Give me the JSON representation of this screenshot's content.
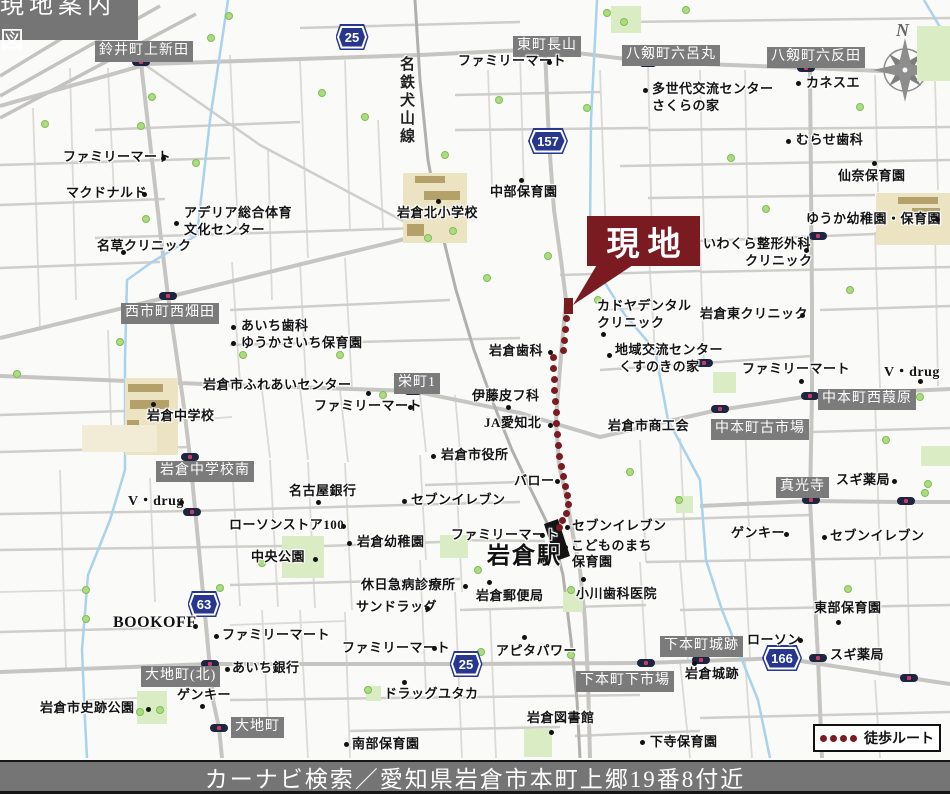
{
  "title": "現地案内図",
  "caption": "カーナビ検索／愛知県岩倉市本町上郷19番8付近",
  "site_label": "現地",
  "station_label": "岩倉駅",
  "railway_label": "名鉄犬山線",
  "legend_label": "徒歩ルート",
  "compass_letter": "N",
  "colors": {
    "accent_maroon": "#7a1b21",
    "shield_blue": "#27368f",
    "district_label_gray": "#7b7b7b",
    "park_green": "#d9ecc3",
    "school_tan": "#ece3c2",
    "water_blue": "#a9d2ec",
    "road_gray": "#c6c5c1"
  },
  "map": {
    "legend_dot_count": 4,
    "shields": [
      {
        "x": 352,
        "y": 37,
        "num": "25"
      },
      {
        "x": 548,
        "y": 141,
        "num": "157"
      },
      {
        "x": 204,
        "y": 604,
        "num": "63"
      },
      {
        "x": 466,
        "y": 664,
        "num": "25"
      },
      {
        "x": 782,
        "y": 658,
        "num": "166"
      }
    ],
    "area_labels": [
      {
        "x": 95,
        "y": 41,
        "t": "鈴井町上新田"
      },
      {
        "x": 513,
        "y": 36,
        "t": "東町長山"
      },
      {
        "x": 622,
        "y": 45,
        "t": "八剱町六呂丸"
      },
      {
        "x": 767,
        "y": 47,
        "t": "八剱町六反田"
      },
      {
        "x": 121,
        "y": 303,
        "t": "西市町西畑田"
      },
      {
        "x": 394,
        "y": 373,
        "t": "栄町1"
      },
      {
        "x": 818,
        "y": 389,
        "t": "中本町西葭原"
      },
      {
        "x": 711,
        "y": 419,
        "t": "中本町古市場"
      },
      {
        "x": 156,
        "y": 461,
        "t": "岩倉中学校南"
      },
      {
        "x": 776,
        "y": 477,
        "t": "真光寺"
      },
      {
        "x": 660,
        "y": 636,
        "t": "下本町城跡"
      },
      {
        "x": 141,
        "y": 666,
        "t": "大地町(北)"
      },
      {
        "x": 576,
        "y": 671,
        "t": "下本町下市場"
      },
      {
        "x": 231,
        "y": 717,
        "t": "大地町"
      }
    ],
    "pois": [
      {
        "t": "ファミリーマート",
        "x": 63,
        "y": 150,
        "dot": [
          163,
          158
        ]
      },
      {
        "t": "マクドナルド",
        "x": 66,
        "y": 186,
        "dot": [
          144,
          194
        ]
      },
      {
        "t": "アデリア総合体育",
        "x": 184,
        "y": 206,
        "dot": [
          176,
          223
        ]
      },
      {
        "t": "文化センター",
        "x": 184,
        "y": 223,
        "dot": null
      },
      {
        "t": "名草クリニック",
        "x": 97,
        "y": 239,
        "dot": [
          123,
          252
        ]
      },
      {
        "t": "ファミリーマート",
        "x": 458,
        "y": 54,
        "dot": [
          549,
          62
        ]
      },
      {
        "t": "多世代交流センター",
        "x": 652,
        "y": 82,
        "dot": [
          645,
          90
        ]
      },
      {
        "t": "さくらの家",
        "x": 652,
        "y": 99,
        "dot": null
      },
      {
        "t": "カネスエ",
        "x": 806,
        "y": 76,
        "dot": [
          798,
          83
        ]
      },
      {
        "t": "むらせ歯科",
        "x": 796,
        "y": 133,
        "dot": [
          788,
          141
        ]
      },
      {
        "t": "仙奈保育園",
        "x": 838,
        "y": 169,
        "dot": [
          874,
          163
        ]
      },
      {
        "t": "ゆうか幼稚園・保育園",
        "x": 806,
        "y": 212,
        "dot": [
          937,
          219
        ]
      },
      {
        "t": "いわくら整形外科",
        "x": 703,
        "y": 237,
        "dot": [
          806,
          250
        ]
      },
      {
        "t": "クリニック",
        "x": 745,
        "y": 254,
        "dot": null
      },
      {
        "t": "中部保育園",
        "x": 490,
        "y": 185,
        "dot": [
          521,
          180
        ]
      },
      {
        "t": "岩倉北小学校",
        "x": 397,
        "y": 206,
        "dot": [
          438,
          201
        ]
      },
      {
        "t": "カドヤデンタル",
        "x": 597,
        "y": 299,
        "dot": [
          603,
          334
        ]
      },
      {
        "t": "クリニック",
        "x": 597,
        "y": 316,
        "dot": null
      },
      {
        "t": "岩倉東クリニック",
        "x": 700,
        "y": 307,
        "dot": [
          802,
          315
        ]
      },
      {
        "t": "地域交流センター",
        "x": 615,
        "y": 343,
        "dot": [
          609,
          355
        ]
      },
      {
        "t": "くすのきの家",
        "x": 619,
        "y": 360,
        "dot": null
      },
      {
        "t": "ファミリーマート",
        "x": 742,
        "y": 362,
        "dot": [
          801,
          381
        ]
      },
      {
        "t": "V・drug",
        "x": 884,
        "y": 365,
        "dot": [
          920,
          381
        ],
        "fs": 14
      },
      {
        "t": "岩倉歯科",
        "x": 489,
        "y": 344,
        "dot": [
          550,
          352
        ]
      },
      {
        "t": "あいち歯科",
        "x": 241,
        "y": 319,
        "dot": [
          233,
          327
        ]
      },
      {
        "t": "ゆうかさいち保育園",
        "x": 241,
        "y": 336,
        "dot": [
          233,
          343
        ]
      },
      {
        "t": "岩倉市ふれあいセンター",
        "x": 203,
        "y": 378,
        "dot": [
          368,
          393
        ]
      },
      {
        "t": "ファミリーマート",
        "x": 314,
        "y": 399,
        "dot": [
          410,
          407
        ]
      },
      {
        "t": "伊藤皮フ科",
        "x": 472,
        "y": 389,
        "dot": [
          508,
          407
        ]
      },
      {
        "t": "JA愛知北",
        "x": 484,
        "y": 416,
        "dot": [
          550,
          425
        ]
      },
      {
        "t": "岩倉市役所",
        "x": 441,
        "y": 448,
        "dot": [
          433,
          456
        ]
      },
      {
        "t": "バロー",
        "x": 514,
        "y": 474,
        "dot": [
          557,
          481
        ]
      },
      {
        "t": "名古屋銀行",
        "x": 289,
        "y": 484,
        "dot": [
          318,
          502
        ]
      },
      {
        "t": "セブンイレブン",
        "x": 411,
        "y": 493,
        "dot": [
          404,
          501
        ]
      },
      {
        "t": "ローソンストア100",
        "x": 229,
        "y": 518,
        "dot": [
          343,
          526
        ]
      },
      {
        "t": "岩倉幼稚園",
        "x": 357,
        "y": 535,
        "dot": [
          349,
          543
        ]
      },
      {
        "t": "中央公園",
        "x": 251,
        "y": 550,
        "dot": [
          315,
          559
        ]
      },
      {
        "t": "休日急病診療所",
        "x": 361,
        "y": 578,
        "dot": [
          465,
          586
        ]
      },
      {
        "t": "サンドラッグ",
        "x": 356,
        "y": 600,
        "dot": [
          427,
          608
        ]
      },
      {
        "t": "岩倉郵便局",
        "x": 476,
        "y": 589,
        "dot": [
          489,
          582
        ]
      },
      {
        "t": "小川歯科医院",
        "x": 576,
        "y": 587,
        "dot": [
          583,
          579
        ]
      },
      {
        "t": "セブンイレブン",
        "x": 572,
        "y": 519,
        "dot": [
          567,
          527
        ]
      },
      {
        "t": "こどものまち",
        "x": 571,
        "y": 539,
        "dot": [
          565,
          547
        ]
      },
      {
        "t": "保育園",
        "x": 572,
        "y": 555,
        "dot": null
      },
      {
        "t": "ファミリーマート",
        "x": 451,
        "y": 528,
        "dot": [
          542,
          535
        ]
      },
      {
        "t": "BOOKOFF",
        "x": 113,
        "y": 614,
        "dot": [
          195,
          626
        ],
        "fs": 16
      },
      {
        "t": "ファミリーマート",
        "x": 222,
        "y": 628,
        "dot": [
          216,
          636
        ]
      },
      {
        "t": "あいち銀行",
        "x": 232,
        "y": 661,
        "dot": [
          227,
          669
        ]
      },
      {
        "t": "ゲンキー",
        "x": 177,
        "y": 688,
        "dot": [
          202,
          706
        ]
      },
      {
        "t": "岩倉市史跡公園",
        "x": 40,
        "y": 701,
        "dot": [
          148,
          709
        ]
      },
      {
        "t": "南部保育園",
        "x": 352,
        "y": 737,
        "dot": [
          346,
          744
        ]
      },
      {
        "t": "ドラッグユタカ",
        "x": 384,
        "y": 687,
        "dot": [
          404,
          682
        ]
      },
      {
        "t": "ファミリーマート",
        "x": 342,
        "y": 641,
        "dot": [
          434,
          648
        ]
      },
      {
        "t": "アピタパワー",
        "x": 496,
        "y": 644,
        "dot": [
          524,
          637
        ]
      },
      {
        "t": "岩倉図書館",
        "x": 527,
        "y": 711,
        "dot": [
          551,
          732
        ]
      },
      {
        "t": "東部保育園",
        "x": 814,
        "y": 601,
        "dot": [
          838,
          622
        ]
      },
      {
        "t": "ローソン",
        "x": 747,
        "y": 633,
        "dot": [
          800,
          640
        ]
      },
      {
        "t": "スギ薬局",
        "x": 830,
        "y": 648,
        "dot": null
      },
      {
        "t": "岩倉城跡",
        "x": 685,
        "y": 667,
        "dot": [
          694,
          663
        ]
      },
      {
        "t": "下寺保育園",
        "x": 650,
        "y": 735,
        "dot": [
          642,
          742
        ]
      },
      {
        "t": "ゲンキー",
        "x": 731,
        "y": 526,
        "dot": [
          786,
          534
        ]
      },
      {
        "t": "セブンイレブン",
        "x": 830,
        "y": 529,
        "dot": [
          824,
          537
        ]
      },
      {
        "t": "スギ薬局",
        "x": 836,
        "y": 473,
        "dot": [
          894,
          481
        ]
      },
      {
        "t": "岩倉市商工会",
        "x": 608,
        "y": 419,
        "dot": null
      },
      {
        "t": "岩倉中学校",
        "x": 147,
        "y": 409,
        "dot": [
          153,
          404
        ]
      },
      {
        "t": "V・drug",
        "x": 128,
        "y": 494,
        "dot": [
          181,
          502
        ],
        "fs": 14
      }
    ],
    "signals": [
      [
        141,
        62
      ],
      [
        545,
        52
      ],
      [
        648,
        63
      ],
      [
        806,
        68
      ],
      [
        818,
        236
      ],
      [
        168,
        296
      ],
      [
        704,
        363
      ],
      [
        413,
        391
      ],
      [
        810,
        396
      ],
      [
        720,
        409
      ],
      [
        190,
        457
      ],
      [
        811,
        500
      ],
      [
        906,
        501
      ],
      [
        192,
        512
      ],
      [
        210,
        664
      ],
      [
        219,
        728
      ],
      [
        646,
        663
      ],
      [
        701,
        660
      ],
      [
        818,
        658
      ],
      [
        909,
        678
      ]
    ],
    "trees": [
      [
        45,
        124
      ],
      [
        152,
        97
      ],
      [
        141,
        126
      ],
      [
        196,
        163
      ],
      [
        146,
        219
      ],
      [
        229,
        16
      ],
      [
        211,
        38
      ],
      [
        322,
        93
      ],
      [
        365,
        117
      ],
      [
        445,
        155
      ],
      [
        499,
        100
      ],
      [
        587,
        108
      ],
      [
        607,
        13
      ],
      [
        624,
        22
      ],
      [
        686,
        10
      ],
      [
        860,
        107
      ],
      [
        766,
        209
      ],
      [
        731,
        158
      ],
      [
        17,
        374
      ],
      [
        120,
        342
      ],
      [
        243,
        355
      ],
      [
        340,
        355
      ],
      [
        383,
        395
      ],
      [
        487,
        278
      ],
      [
        548,
        256
      ],
      [
        630,
        472
      ],
      [
        571,
        590
      ],
      [
        428,
        238
      ],
      [
        453,
        231
      ],
      [
        86,
        590
      ],
      [
        86,
        619
      ],
      [
        220,
        588
      ],
      [
        262,
        563
      ],
      [
        140,
        712
      ],
      [
        478,
        570
      ],
      [
        481,
        652
      ],
      [
        571,
        655
      ],
      [
        586,
        688
      ],
      [
        679,
        500
      ],
      [
        850,
        290
      ],
      [
        886,
        440
      ],
      [
        920,
        397
      ],
      [
        928,
        484
      ],
      [
        848,
        589
      ],
      [
        925,
        493
      ],
      [
        368,
        690
      ],
      [
        160,
        710
      ],
      [
        598,
        300
      ]
    ],
    "parks": [
      [
        282,
        536,
        42,
        42
      ],
      [
        137,
        691,
        30,
        33
      ],
      [
        524,
        729,
        28,
        28
      ],
      [
        611,
        6,
        30,
        27
      ],
      [
        917,
        26,
        33,
        55
      ],
      [
        713,
        372,
        23,
        21
      ],
      [
        676,
        496,
        17,
        17
      ],
      [
        440,
        535,
        28,
        23
      ],
      [
        921,
        446,
        29,
        20
      ],
      [
        366,
        686,
        15,
        15
      ],
      [
        563,
        592,
        20,
        20
      ]
    ],
    "schools": [
      {
        "area": [
          403,
          173,
          64,
          70
        ],
        "bars": [
          [
            415,
            176,
            30,
            7
          ],
          [
            424,
            191,
            36,
            9
          ],
          [
            407,
            224,
            17,
            12
          ]
        ],
        "lite": false
      },
      {
        "area": [
          125,
          378,
          53,
          77
        ],
        "bars": [
          [
            128,
            384,
            35,
            8
          ],
          [
            130,
            400,
            39,
            9
          ],
          [
            127,
            420,
            12,
            28
          ]
        ],
        "lite": false
      },
      {
        "area": [
          876,
          193,
          74,
          52
        ],
        "bars": [
          [
            898,
            197,
            40,
            7
          ],
          [
            912,
            208,
            28,
            8
          ]
        ],
        "lite": false
      },
      {
        "area": [
          82,
          425,
          75,
          27
        ],
        "bars": [],
        "lite": true
      }
    ],
    "route_dots": [
      [
        566,
        318
      ],
      [
        565,
        329
      ],
      [
        564,
        340
      ],
      [
        563,
        350
      ],
      [
        553,
        357
      ],
      [
        553,
        368
      ],
      [
        554,
        379
      ],
      [
        554,
        390
      ],
      [
        555,
        401
      ],
      [
        556,
        412
      ],
      [
        556,
        423
      ],
      [
        557,
        434
      ],
      [
        558,
        445
      ],
      [
        559,
        456
      ],
      [
        561,
        466
      ],
      [
        563,
        476
      ],
      [
        565,
        486
      ],
      [
        567,
        495
      ],
      [
        568,
        504
      ],
      [
        566,
        513
      ],
      [
        562,
        520
      ],
      [
        559,
        527
      ]
    ]
  }
}
